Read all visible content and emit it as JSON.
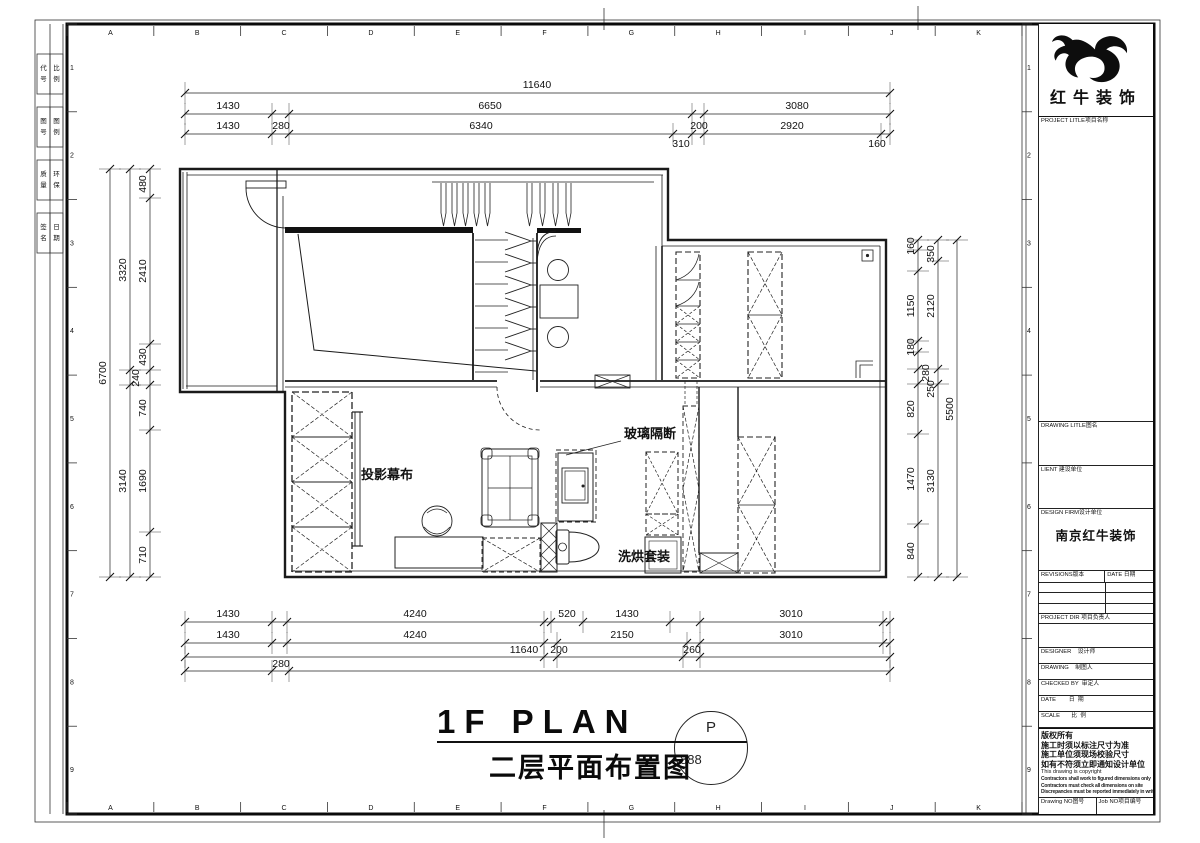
{
  "sheet": {
    "grid_letters": [
      "A",
      "B",
      "C",
      "D",
      "E",
      "F",
      "G",
      "H",
      "I",
      "J",
      "K"
    ],
    "grid_numbers": [
      "1",
      "2",
      "3",
      "4",
      "5",
      "6",
      "7",
      "8",
      "9"
    ],
    "edge_cells": [
      {
        "a": "代号",
        "b": "比例"
      },
      {
        "a": "图号",
        "b": "图例"
      },
      {
        "a": "质量",
        "b": "环保"
      },
      {
        "a": "签名",
        "b": "日期"
      }
    ]
  },
  "caption": {
    "title_en": "1F PLAN",
    "title_zh": "二层平面布置图",
    "bubble_top": "P",
    "bubble_num": "888"
  },
  "plan": {
    "labels": [
      {
        "t": "投影幕布",
        "x": 361,
        "y": 479
      },
      {
        "t": "玻璃隔断",
        "x": 624,
        "y": 438,
        "leader": [
          621,
          441,
          566,
          455
        ]
      },
      {
        "t": "洗烘套装",
        "x": 618,
        "y": 561
      }
    ],
    "dims": [
      {
        "dir": "h",
        "x1": 185,
        "x2": 890,
        "y": 93,
        "ticks": [
          185,
          890
        ],
        "labels": [
          {
            "t": "11640",
            "x": 537,
            "y": 88
          }
        ]
      },
      {
        "dir": "h",
        "x1": 185,
        "x2": 890,
        "y": 114,
        "ticks": [
          185,
          272,
          289,
          692,
          704,
          890
        ],
        "labels": [
          {
            "t": "1430",
            "x": 228,
            "y": 109
          },
          {
            "t": "6650",
            "x": 490,
            "y": 109
          },
          {
            "t": "3080",
            "x": 797,
            "y": 109
          }
        ]
      },
      {
        "dir": "h",
        "x1": 185,
        "x2": 890,
        "y": 134,
        "ticks": [
          185,
          272,
          289,
          673,
          692,
          704,
          881,
          890
        ],
        "labels": [
          {
            "t": "1430",
            "x": 228,
            "y": 129
          },
          {
            "t": "280",
            "x": 281,
            "y": 129
          },
          {
            "t": "6340",
            "x": 481,
            "y": 129
          },
          {
            "t": "200",
            "x": 699,
            "y": 129
          },
          {
            "t": "2920",
            "x": 792,
            "y": 129
          },
          {
            "t": "310",
            "x": 681,
            "y": 147
          },
          {
            "t": "160",
            "x": 877,
            "y": 147
          }
        ]
      },
      {
        "dir": "v",
        "x": 110,
        "y1": 169,
        "y2": 577,
        "ticks": [
          169,
          577
        ],
        "labels": [
          {
            "t": "6700",
            "x": 106,
            "y": 373,
            "rot": 1
          }
        ]
      },
      {
        "dir": "v",
        "x": 130,
        "y1": 169,
        "y2": 577,
        "ticks": [
          169,
          370,
          385,
          577
        ],
        "labels": [
          {
            "t": "3320",
            "x": 126,
            "y": 270,
            "rot": 1
          },
          {
            "t": "3140",
            "x": 126,
            "y": 481,
            "rot": 1
          }
        ]
      },
      {
        "dir": "v",
        "x": 150,
        "y1": 169,
        "y2": 577,
        "ticks": [
          169,
          198,
          344,
          370,
          385,
          430,
          532,
          577
        ],
        "labels": [
          {
            "t": "480",
            "x": 146,
            "y": 184,
            "rot": 1
          },
          {
            "t": "2410",
            "x": 146,
            "y": 271,
            "rot": 1
          },
          {
            "t": "430",
            "x": 146,
            "y": 357,
            "rot": 1
          },
          {
            "t": "240",
            "x": 139,
            "y": 378,
            "rot": 1
          },
          {
            "t": "740",
            "x": 146,
            "y": 408,
            "rot": 1
          },
          {
            "t": "1690",
            "x": 146,
            "y": 481,
            "rot": 1
          },
          {
            "t": "710",
            "x": 146,
            "y": 555,
            "rot": 1
          }
        ]
      },
      {
        "dir": "v",
        "x": 918,
        "y1": 240,
        "y2": 577,
        "ticks": [
          240,
          250,
          271,
          341,
          352,
          369,
          384,
          434,
          524,
          577
        ],
        "labels": [
          {
            "t": "160",
            "x": 914,
            "y": 246,
            "rot": 1
          },
          {
            "t": "1150",
            "x": 914,
            "y": 306,
            "rot": 1
          },
          {
            "t": "180",
            "x": 914,
            "y": 347,
            "rot": 1
          },
          {
            "t": "820",
            "x": 914,
            "y": 409,
            "rot": 1
          },
          {
            "t": "1470",
            "x": 914,
            "y": 479,
            "rot": 1
          },
          {
            "t": "840",
            "x": 914,
            "y": 551,
            "rot": 1
          }
        ]
      },
      {
        "dir": "v",
        "x": 938,
        "y1": 240,
        "y2": 577,
        "ticks": [
          240,
          261,
          369,
          384,
          577
        ],
        "labels": [
          {
            "t": "350",
            "x": 934,
            "y": 254,
            "rot": 1
          },
          {
            "t": "2120",
            "x": 934,
            "y": 306,
            "rot": 1
          },
          {
            "t": "280",
            "x": 929,
            "y": 373,
            "rot": 1
          },
          {
            "t": "250",
            "x": 934,
            "y": 389,
            "rot": 1
          },
          {
            "t": "3130",
            "x": 934,
            "y": 481,
            "rot": 1
          }
        ]
      },
      {
        "dir": "v",
        "x": 957,
        "y1": 240,
        "y2": 577,
        "ticks": [
          240,
          577
        ],
        "labels": [
          {
            "t": "5500",
            "x": 953,
            "y": 409,
            "rot": 1
          }
        ]
      },
      {
        "dir": "h",
        "x1": 185,
        "x2": 890,
        "y": 622,
        "ticks": [
          185,
          272,
          287,
          544,
          551,
          583,
          670,
          700,
          883,
          890
        ],
        "labels": [
          {
            "t": "1430",
            "x": 228,
            "y": 617
          },
          {
            "t": "4240",
            "x": 415,
            "y": 617
          },
          {
            "t": "520",
            "x": 567,
            "y": 617
          },
          {
            "t": "1430",
            "x": 627,
            "y": 617
          },
          {
            "t": "3010",
            "x": 791,
            "y": 617
          }
        ]
      },
      {
        "dir": "h",
        "x1": 185,
        "x2": 890,
        "y": 643,
        "ticks": [
          185,
          272,
          287,
          544,
          557,
          687,
          700,
          883,
          890
        ],
        "labels": [
          {
            "t": "1430",
            "x": 228,
            "y": 638
          },
          {
            "t": "4240",
            "x": 415,
            "y": 638
          },
          {
            "t": "2150",
            "x": 622,
            "y": 638
          },
          {
            "t": "3010",
            "x": 791,
            "y": 638
          }
        ]
      },
      {
        "dir": "h",
        "x1": 185,
        "x2": 890,
        "y": 657,
        "ticks": [
          185,
          544,
          557,
          683,
          700,
          890
        ],
        "labels": [
          {
            "t": "11640",
            "x": 524,
            "y": 653
          },
          {
            "t": "200",
            "x": 559,
            "y": 653
          },
          {
            "t": "260",
            "x": 692,
            "y": 653
          }
        ]
      },
      {
        "dir": "h",
        "x1": 185,
        "x2": 890,
        "y": 671,
        "ticks": [
          185,
          272,
          289,
          890
        ],
        "labels": [
          {
            "t": "280",
            "x": 281,
            "y": 667
          }
        ]
      }
    ]
  },
  "titleblock": {
    "logo_name": "红牛装饰",
    "project_label": "PROJECT LITLE项目名称",
    "drawing_title_label": "DRAWING LITLE图名",
    "client_label": "LIENT 建设单位",
    "firm_label": "DESIGN FIRM设计单位",
    "firm_name": "南京红牛装饰",
    "revisions_label": "REVISIONS版本",
    "rev_date_label": "DATE 日期",
    "project_dir_label": "PROJECT DIR 项目负责人",
    "designer_label": "DESIGNER    设计师",
    "drafter_label": "DRAWING    制图人",
    "checked_label": "CHECKED BY  审定人",
    "date_label": "DATE        日  期",
    "scale_label": "SCALE       比  例",
    "copyright_cn": [
      "版权所有",
      "施工时须以标注尺寸为准",
      "施工单位须现场校验尺寸",
      "如有不符须立即通知设计单位"
    ],
    "copyright_en": "This drawing is copyright",
    "copyright_smudge": [
      "Contractors shall work to figured dimensions only",
      "Contractors must check all dimensions on site",
      "Discrepancies must be reported immediately in writing"
    ],
    "drawing_no_label": "Drawing NO图号",
    "job_no_label": "Job NO项目编号"
  }
}
